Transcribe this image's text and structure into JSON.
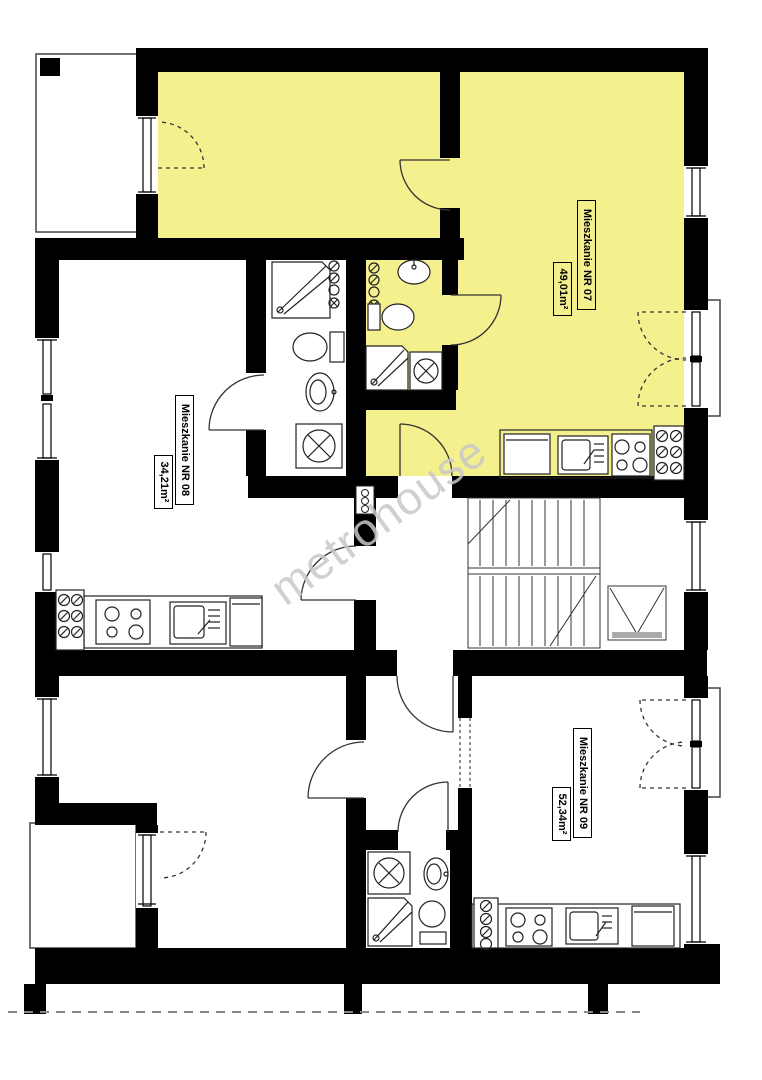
{
  "floorplan": {
    "watermark_text": "metrohouse",
    "colors": {
      "wall": "#000000",
      "highlight": "#f5f08e",
      "thin_line": "#333333",
      "watermark": "#c8c8c8"
    },
    "apartments": [
      {
        "name": "Mieszkanie NR 07",
        "area": "49,01m²",
        "highlighted": true
      },
      {
        "name": "Mieszkanie NR 08",
        "area": "34,21m²",
        "highlighted": false
      },
      {
        "name": "Mieszkanie NR 09",
        "area": "52,34m²",
        "highlighted": false
      }
    ],
    "features": [
      "staircase",
      "elevator-shaft",
      "balcony-top-left",
      "balcony-bottom-left",
      "balcony-right-upper",
      "balcony-right-lower",
      "kitchen-07",
      "kitchen-08",
      "kitchen-09",
      "bathroom-07",
      "bathroom-08",
      "bathroom-09"
    ]
  }
}
